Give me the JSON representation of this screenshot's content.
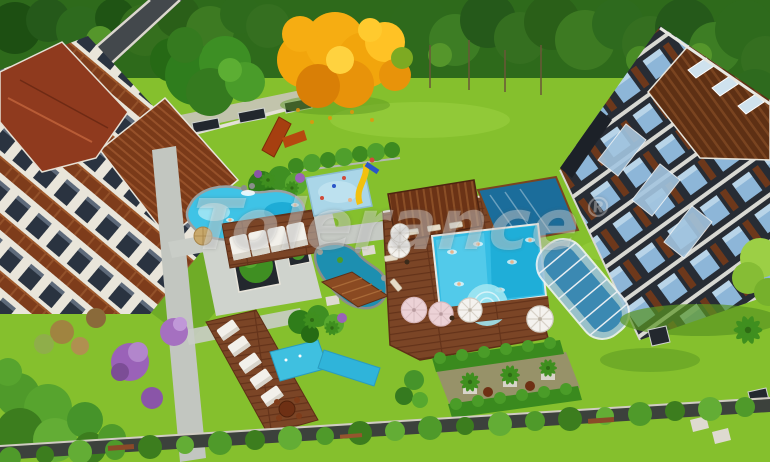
{
  "image": {
    "type": "3d-architectural-aerial-render",
    "subject": "residential complex courtyard with pools, gardens and two apartment buildings surrounded by forest"
  },
  "watermark": {
    "text": "Tolerance",
    "symbol": "®"
  },
  "colors": {
    "lawn": "#85c02d",
    "forest_dark": "#2e6a1b",
    "autumn_orange": "#f2a50c",
    "pool_water": "#35bde4",
    "lap_pool": "#1b6d9b",
    "pond": "#1d8fb0",
    "lagoon": "#3fc3e6",
    "roof_tile": "#8f3a1e",
    "wood_deck": "#7b4526",
    "building_white": "#e9e5da",
    "building_dark": "#272c34",
    "glass_blue": "#8db6d8",
    "path_gray": "#c9cdc7",
    "wall_dark": "#3c413c",
    "purple_tree": "#9a62b8",
    "watermark_white": "rgba(255,255,255,0.33)"
  },
  "scene": {
    "landmarks": [
      "forest band",
      "autumn tree",
      "left apartment building with red tile roof",
      "right dark apartment tower",
      "lagoon pool",
      "cabana canopies",
      "kids splash pad with slide",
      "main pool with deck and umbrellas",
      "lap pool with glass enclosure",
      "garden terraces",
      "perimeter wall and hedge"
    ]
  }
}
